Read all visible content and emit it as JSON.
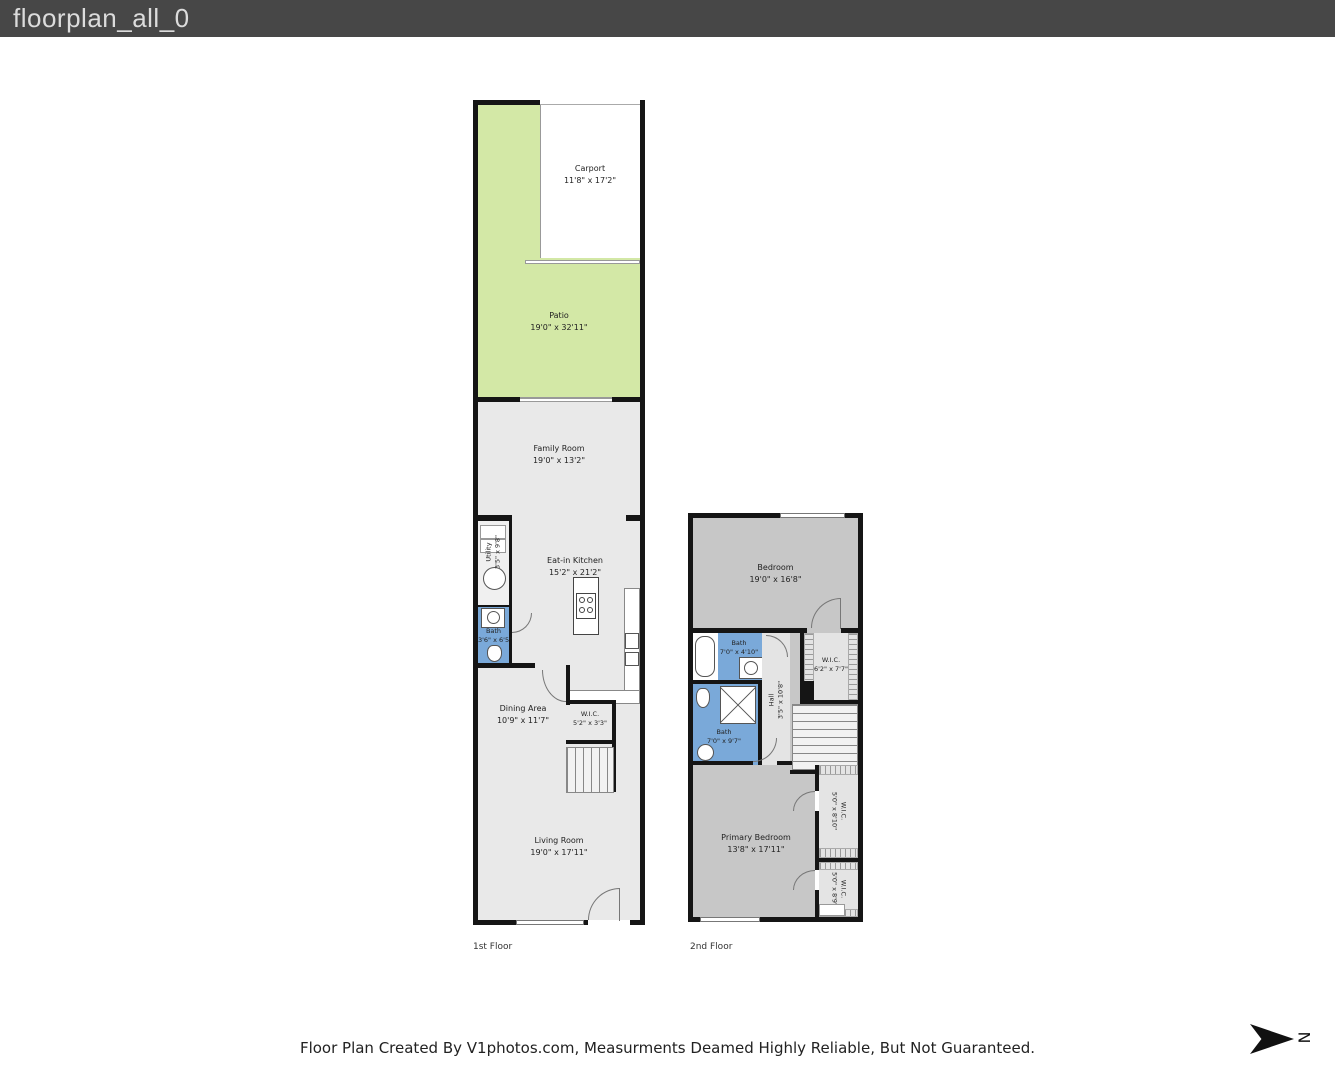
{
  "header": {
    "title": "floorplan_all_0"
  },
  "footer": {
    "disclaimer": "Floor Plan Created By V1photos.com, Measurments Deamed Highly Reliable, But Not Guaranteed."
  },
  "north_label": "N",
  "floors": [
    {
      "label": "1st Floor",
      "rooms": [
        {
          "name": "Carport",
          "dims": "11'8\" x 17'2\""
        },
        {
          "name": "Patio",
          "dims": "19'0\" x 32'11\""
        },
        {
          "name": "Family Room",
          "dims": "19'0\" x 13'2\""
        },
        {
          "name": "Eat-in Kitchen",
          "dims": "15'2\" x 21'2\""
        },
        {
          "name": "Utility",
          "dims": "3'5\" x 9'8\""
        },
        {
          "name": "Bath",
          "dims": "3'6\" x 6'5\""
        },
        {
          "name": "Dining Area",
          "dims": "10'9\" x 11'7\""
        },
        {
          "name": "W.I.C.",
          "dims": "5'2\" x 3'3\""
        },
        {
          "name": "Living Room",
          "dims": "19'0\" x 17'11\""
        }
      ]
    },
    {
      "label": "2nd Floor",
      "rooms": [
        {
          "name": "Bedroom",
          "dims": "19'0\" x 16'8\""
        },
        {
          "name": "Bath",
          "dims": "7'0\" x 4'10\""
        },
        {
          "name": "W.I.C.",
          "dims": "6'2\" x 7'7\""
        },
        {
          "name": "Bath",
          "dims": "7'0\" x 9'7\""
        },
        {
          "name": "Hall",
          "dims": "3'5\" x 10'8\""
        },
        {
          "name": "Primary Bedroom",
          "dims": "13'8\" x 17'11\""
        },
        {
          "name": "W.I.C.",
          "dims": "5'0\" x 8'10\""
        },
        {
          "name": "W.I.C.",
          "dims": "5'0\" x 8'9\""
        }
      ]
    }
  ],
  "colors": {
    "header-bg": "#474747",
    "header-text": "#dcdcdc",
    "wall": "#151515",
    "floor1": "#e9e9e9",
    "floor2": "#c7c7c7",
    "patio": "#d3e8a6",
    "bath": "#7aa9d9",
    "closet": "#e4e4e4",
    "label": "#222222"
  }
}
